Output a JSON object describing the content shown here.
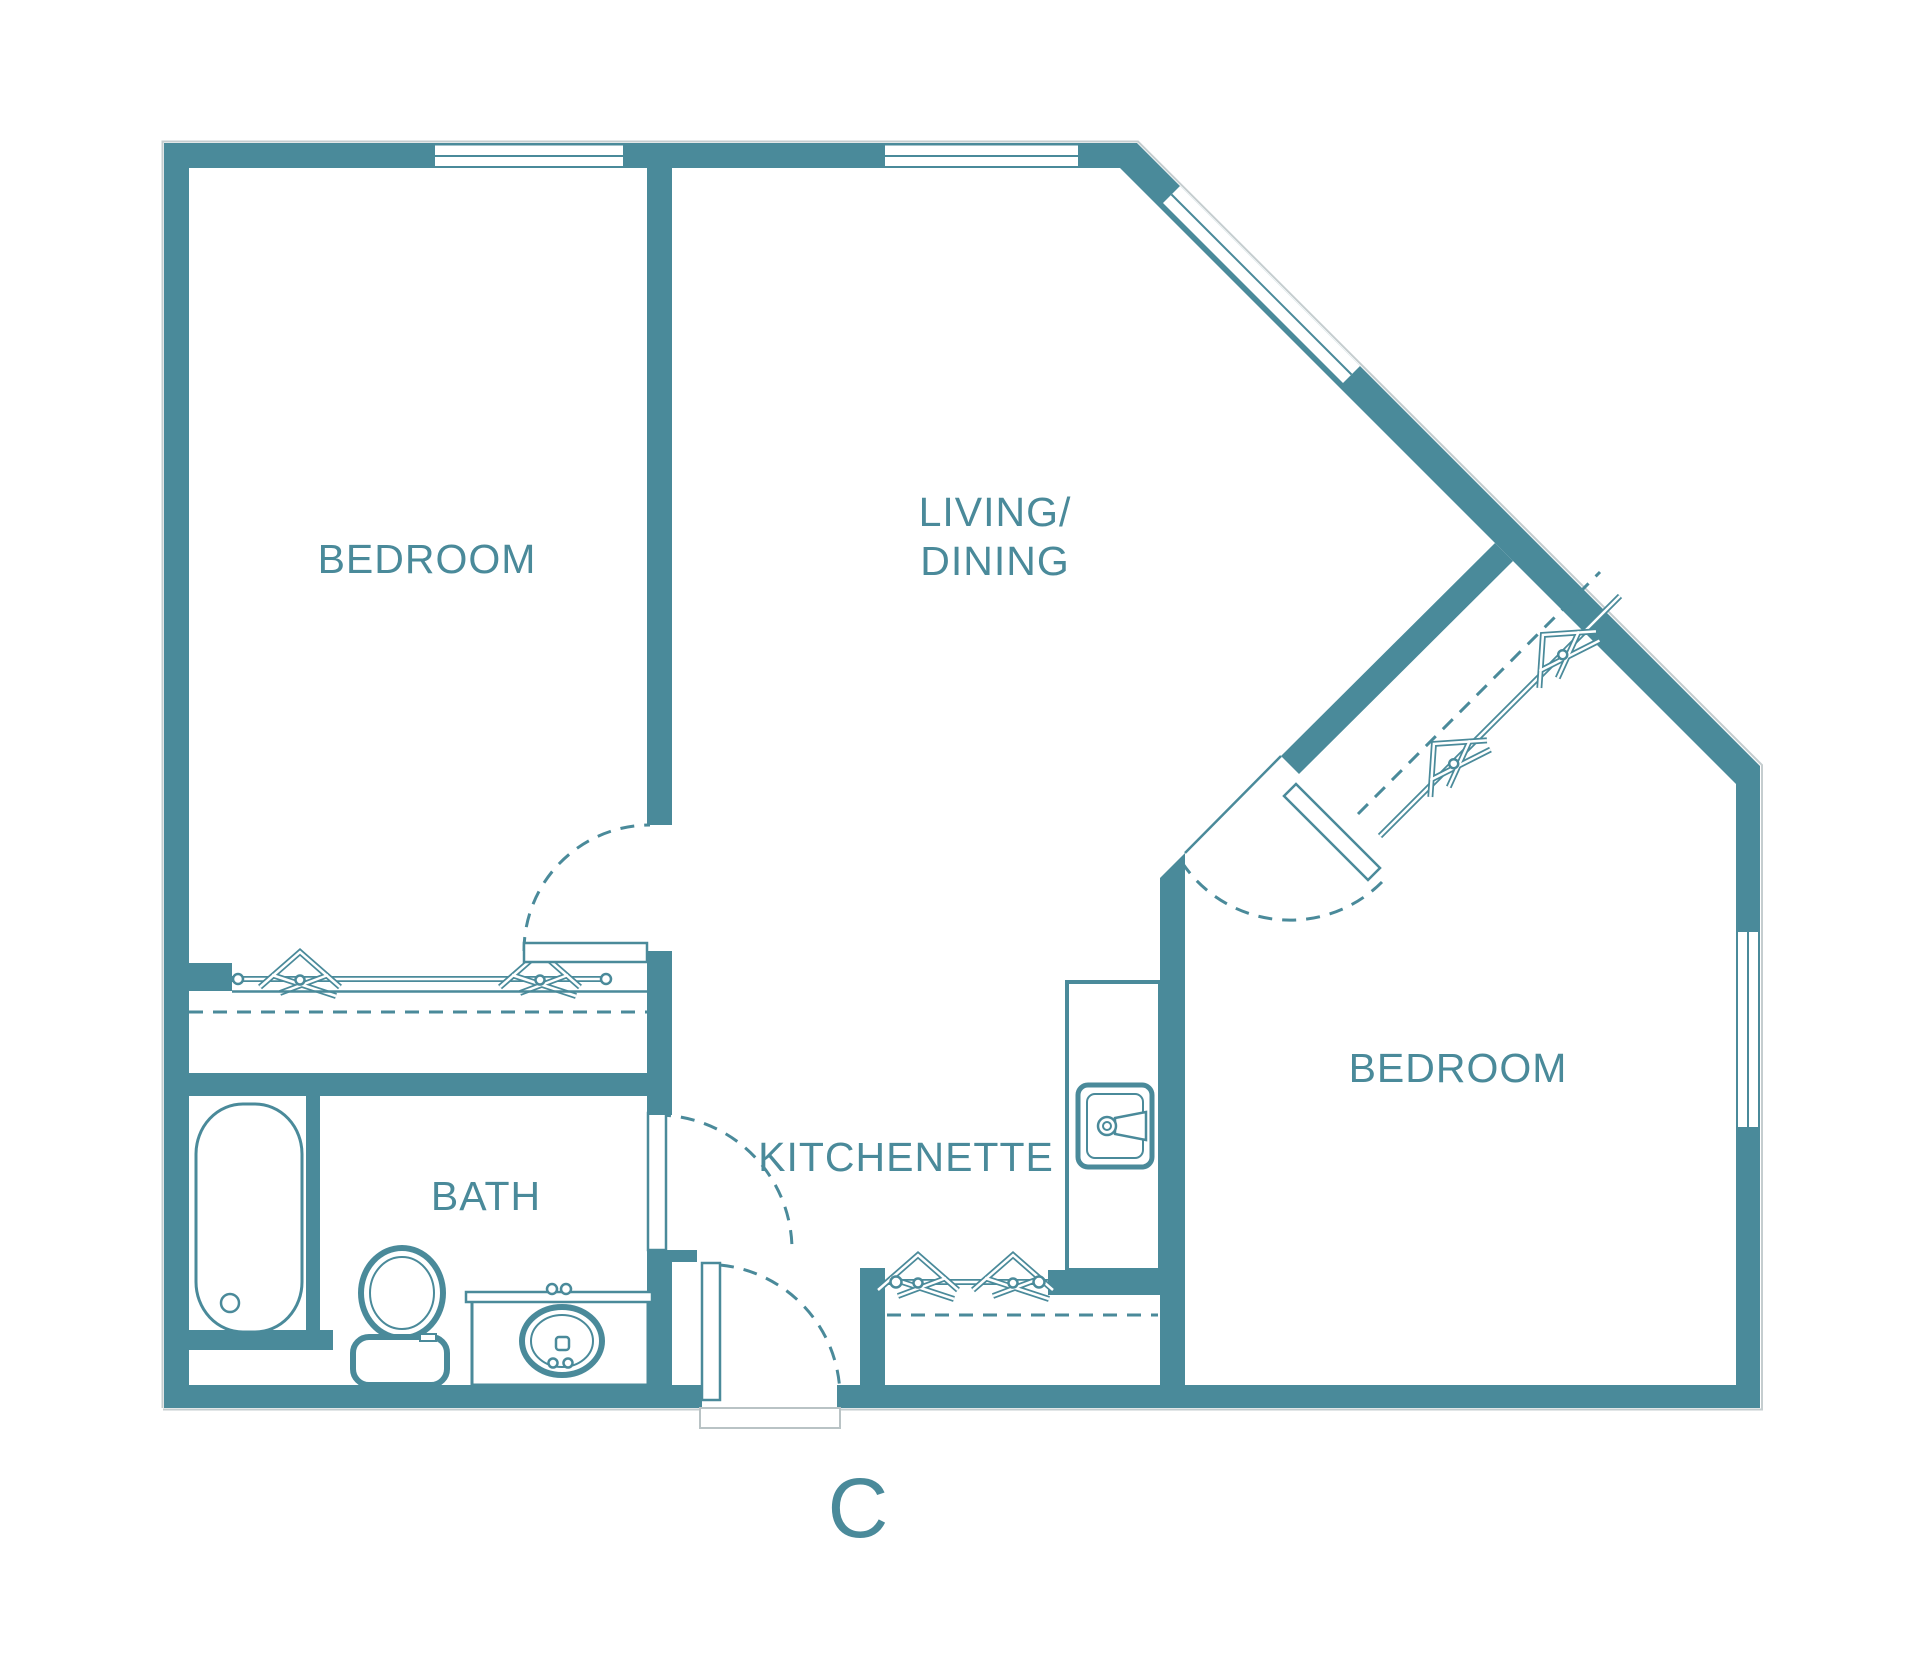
{
  "unit_label": "C",
  "rooms": {
    "bedroom_left": {
      "label": "BEDROOM"
    },
    "living_dining": {
      "line1": "LIVING/",
      "line2": "DINING"
    },
    "bedroom_right": {
      "label": "BEDROOM"
    },
    "bath": {
      "label": "BATH"
    },
    "kitchenette": {
      "label": "KITCHENETTE"
    }
  },
  "fixtures": [
    "bathtub",
    "toilet",
    "vanity-sink",
    "kitchen-sink",
    "closet-rod-with-hangers-bedroom-left",
    "closet-rod-with-hangers-entry",
    "closet-rod-with-hangers-diagonal"
  ],
  "colors": {
    "wall": "#4A8A9A",
    "text": "#4A8A9A",
    "background": "#FFFFFF",
    "shadow": "#C5CDCF"
  }
}
